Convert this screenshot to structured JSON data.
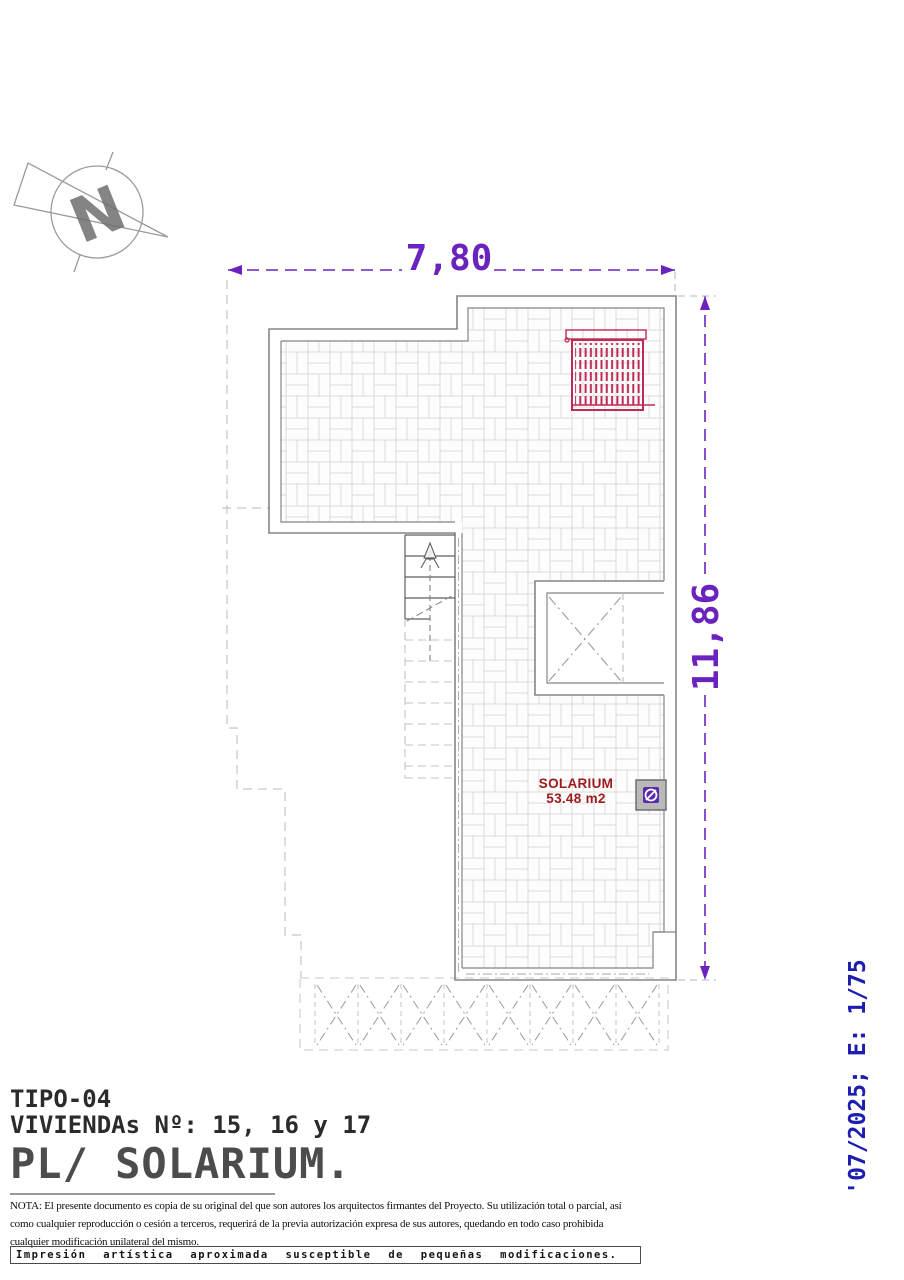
{
  "compass": {
    "letter": "N"
  },
  "dimensions": {
    "top": "7,80",
    "right": "11,86",
    "accent_color": "#6a23be"
  },
  "plan": {
    "room": {
      "name": "SOLARIUM",
      "area": "53.48 m2",
      "label_color": "#9b1b1b"
    },
    "pergola_color": "#bf2b52",
    "wall_color": "#858585"
  },
  "title_block": {
    "type": "TIPO-04",
    "dwellings": "VIVIENDAs Nº: 15, 16 y 17",
    "plan_title": "PL/ SOLARIUM."
  },
  "side_note": {
    "text": "'07/2025; E: 1/75",
    "color": "#1d1db0"
  },
  "nota": {
    "lines": [
      "NOTA: El presente documento es copia de su original del que son autores los arquitectos firmantes del Proyecto. Su utilización total o parcial, así",
      "como cualquier reproducción o cesión a terceros, requerirá  de la previa autorización expresa de sus autores, quedando en todo caso prohibida",
      "cualquier modificación unilateral del mismo."
    ]
  },
  "footer": {
    "disclaimer": "Impresión artística aproximada susceptible de pequeñas modificaciones."
  }
}
